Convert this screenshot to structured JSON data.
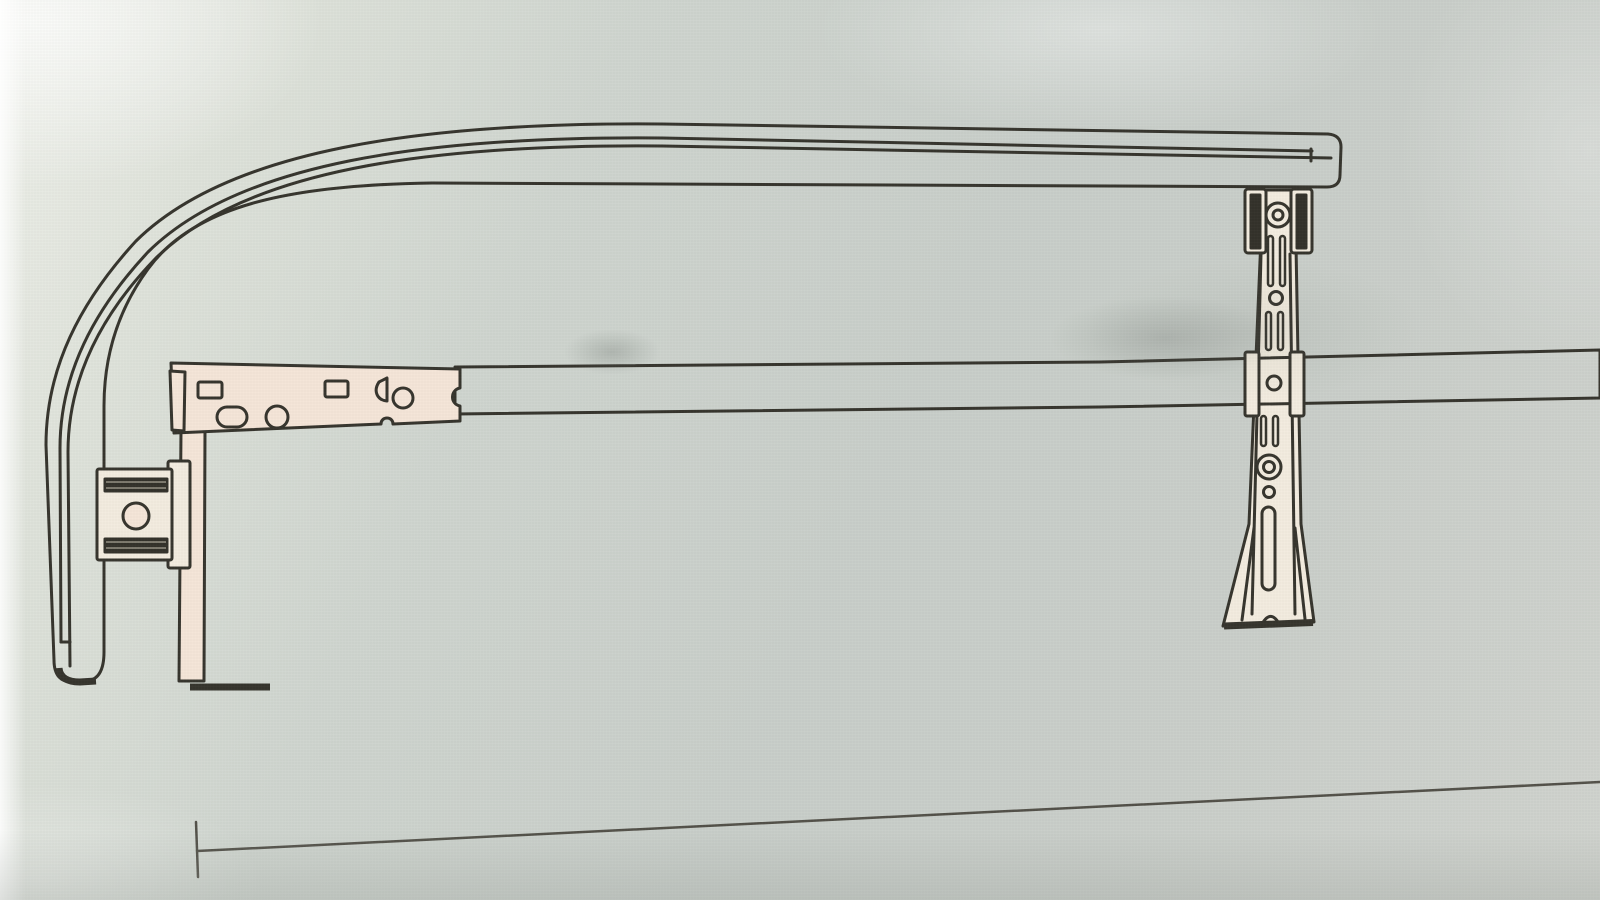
{
  "scene": {
    "kind": "photographed technical line drawing (instruction-manual diagram)",
    "visible_text": "",
    "subject": "curtain track / support rail hardware assembly"
  },
  "colors": {
    "paper": "#cdd2cc",
    "paper_light": "#eef0ea",
    "paper_dark": "#c6ccc7",
    "ink": "#33312a",
    "ink_soft": "#504e46",
    "fill_cream": "#f5e5d8",
    "fill_soft": "#f3ecdf",
    "hardware_dark": "#302e27",
    "shadow": "#68706a"
  },
  "components": {
    "curved_track": "long top rail with rounded return bend descending on the left, rounded end cap at bottom left, squared end cap at right",
    "track_channel_lines": "two parallel channel lines running inside the rail profile",
    "support_bar": "long horizontal flat bar across the middle, extending off the right edge",
    "bracket_plate": "perforated mounting plate at the left end of the support bar with two rectangular holes, one oval slot, two round holes, one wedge cutout, edge notch",
    "bracket_leg": "flat vertical leg dropping from the bracket plate ending in a short right-turned foot",
    "wall_clamp": "clamp block on the leg with two dark gripper bars and a round screw hole",
    "drop_strut": "vertical adjustable strut on the right with slotted holes, round holes, long slot, flared fin feet and arched base notch",
    "strut_rail_clamp": "two dark clamp jaws gripping the strut just below the top rail",
    "strut_bar_tabs": "two white guide tabs where the strut crosses the support bar",
    "dimension_line": "thin measurement line along the bottom with a vertical end tick on the left"
  }
}
